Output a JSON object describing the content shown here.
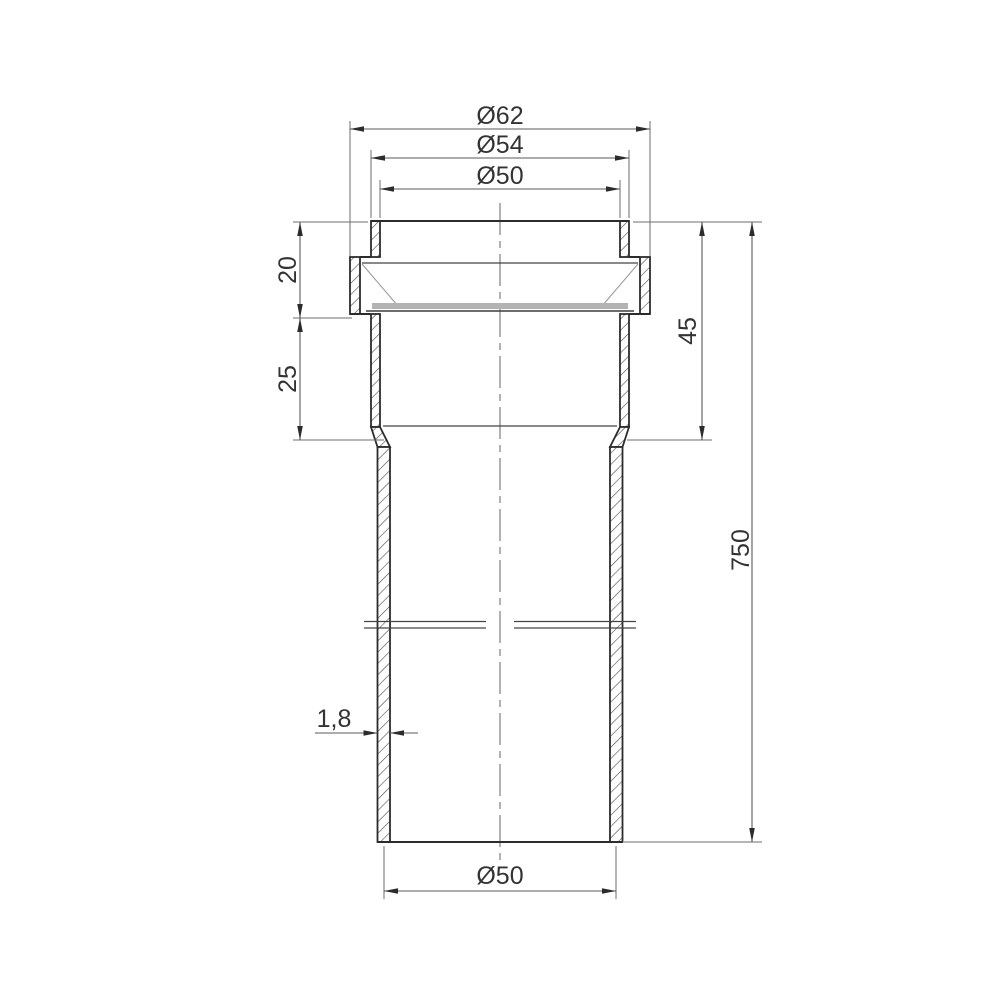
{
  "drawing": {
    "description": "Sectional technical drawing of a plastic pipe with socket (bell) end and sealing-ring groove",
    "background_color": "#ffffff",
    "outline_color": "#2c2c2c",
    "dimension_line_color": "#5a5a5a",
    "text_color": "#333333"
  },
  "dimensions": {
    "groove_outer_diameter": {
      "label": "Ø62",
      "value": 62
    },
    "socket_outer_diameter": {
      "label": "Ø54",
      "value": 54
    },
    "socket_inner_diameter": {
      "label": "Ø50",
      "value": 50
    },
    "groove_height": {
      "label": "20",
      "value": 20
    },
    "socket_lower_height": {
      "label": "25",
      "value": 25
    },
    "socket_depth": {
      "label": "45",
      "value": 45
    },
    "overall_length": {
      "label": "750",
      "value": 750
    },
    "wall_thickness": {
      "label": "1,8",
      "value": 1.8
    },
    "pipe_outer_diameter": {
      "label": "Ø50",
      "value": 50
    }
  }
}
